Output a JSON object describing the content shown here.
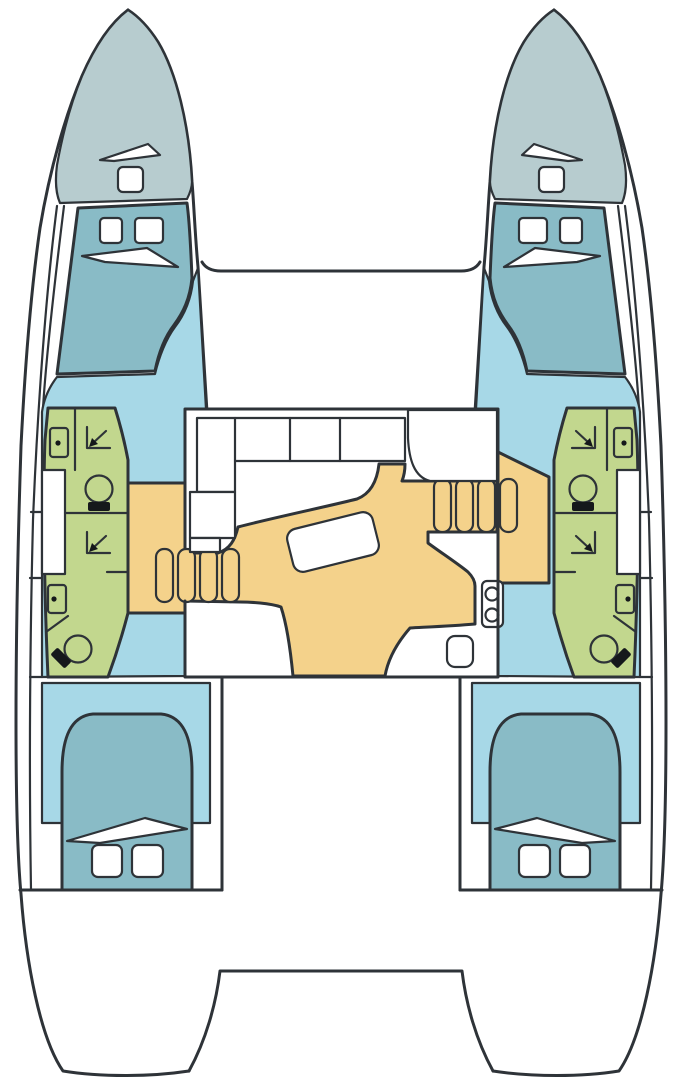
{
  "diagram": {
    "type": "floor-plan",
    "subject": "Catamaran sailing yacht accommodation plan, top-down view, bow up",
    "title": "Catamaran 4-cabin 4-head layout plan",
    "hulls": [
      "port",
      "starboard"
    ],
    "rooms": [
      {
        "id": "port-bow-locker",
        "label": "Port bow locker / foredeck",
        "color_key": "bow_deck",
        "features": [
          "deck hatch",
          "vent wedge"
        ]
      },
      {
        "id": "starboard-bow-locker",
        "label": "Starboard bow locker / foredeck",
        "color_key": "bow_deck",
        "features": [
          "deck hatch",
          "vent wedge"
        ]
      },
      {
        "id": "port-forward-cabin",
        "label": "Port forward double cabin",
        "color_key": "bed_teal",
        "features": [
          "double berth",
          "two hatches",
          "pillow wedge"
        ]
      },
      {
        "id": "starboard-forward-cabin",
        "label": "Starboard forward double cabin",
        "color_key": "bed_teal",
        "features": [
          "double berth",
          "two hatches",
          "pillow wedge"
        ]
      },
      {
        "id": "port-forward-head",
        "label": "Port forward head",
        "color_key": "bathroom_green",
        "features": [
          "shower",
          "toilet",
          "washbasin"
        ]
      },
      {
        "id": "port-aft-head",
        "label": "Port aft head",
        "color_key": "bathroom_green",
        "features": [
          "shower",
          "toilet",
          "washbasin"
        ]
      },
      {
        "id": "starboard-forward-head",
        "label": "Starboard forward head",
        "color_key": "bathroom_green",
        "features": [
          "shower",
          "toilet",
          "washbasin"
        ]
      },
      {
        "id": "starboard-aft-head",
        "label": "Starboard aft head",
        "color_key": "bathroom_green",
        "features": [
          "shower",
          "toilet",
          "washbasin"
        ]
      },
      {
        "id": "salon",
        "label": "Salon / galley on bridgedeck",
        "color_key": "salon_floor_tan",
        "features": [
          "L-settee",
          "cocktail table",
          "chart seat",
          "two-burner stove",
          "galley sink",
          "companionway"
        ]
      },
      {
        "id": "port-staircase",
        "label": "Port hull staircase",
        "color_key": "salon_floor_tan",
        "features": [
          "4 steps",
          "landing"
        ]
      },
      {
        "id": "starboard-staircase",
        "label": "Starboard hull staircase",
        "color_key": "salon_floor_tan",
        "features": [
          "4 steps",
          "landing"
        ]
      },
      {
        "id": "port-aft-cabin",
        "label": "Port aft double cabin",
        "color_key": "bed_teal",
        "features": [
          "double berth",
          "two hatches",
          "pillow wedge"
        ]
      },
      {
        "id": "starboard-aft-cabin",
        "label": "Starboard aft double cabin",
        "color_key": "bed_teal",
        "features": [
          "double berth",
          "two hatches",
          "pillow wedge"
        ]
      },
      {
        "id": "foredeck",
        "label": "Foredeck / trampoline beam",
        "color_key": "hull_white",
        "features": []
      },
      {
        "id": "cockpit",
        "label": "Aft cockpit between hulls",
        "color_key": "hull_white",
        "features": [
          "aft platform beam"
        ]
      },
      {
        "id": "transom-port",
        "label": "Port transom / swim step",
        "color_key": "hull_white",
        "features": []
      },
      {
        "id": "transom-starboard",
        "label": "Starboard transom / swim step",
        "color_key": "hull_white",
        "features": []
      }
    ],
    "fixture_counts": {
      "double_berths": 4,
      "heads": 4,
      "showers": 4,
      "toilets": 4,
      "washbasins": 4,
      "hull_staircases": 2,
      "salon_tables": 1,
      "stove_burners": 2,
      "galley_sinks": 1,
      "bow_deck_hatches": 2,
      "cabin_hatches": 8
    }
  },
  "colors": {
    "background": "#ffffff",
    "hull_white": "#ffffff",
    "outline": "#2e3338",
    "bow_deck": "#b7cccf",
    "bed_teal": "#89bbc6",
    "cabin_floor_blue": "#a7d8e7",
    "bathroom_green": "#c2d78e",
    "salon_floor_tan": "#f4d28b",
    "fixture_black": "#15181b"
  }
}
